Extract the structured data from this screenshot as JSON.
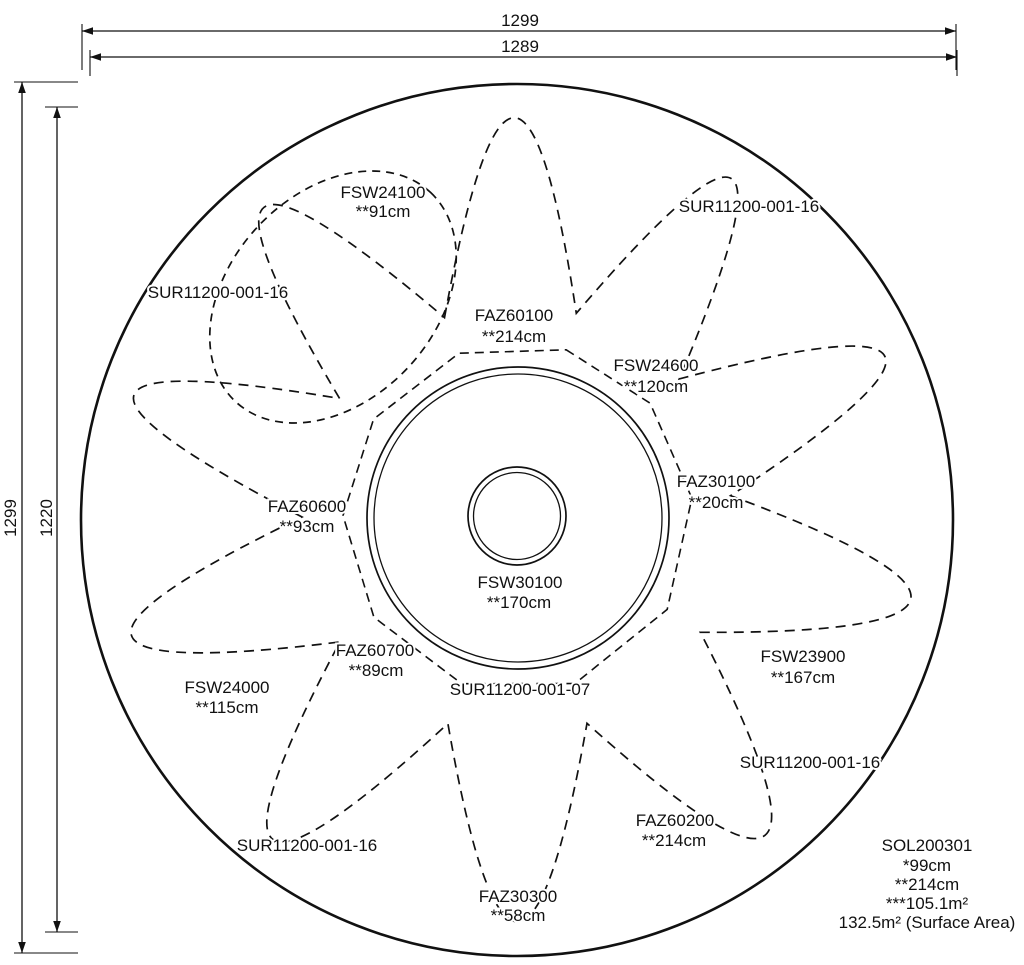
{
  "dimensions": {
    "top_outer": "1299",
    "top_inner": "1289",
    "left_outer": "1299",
    "left_inner": "1220"
  },
  "equipment": [
    {
      "code": "FSW24100",
      "height": "**91cm"
    },
    {
      "code": "FAZ60100",
      "height": "**214cm"
    },
    {
      "code": "FSW24600",
      "height": "**120cm"
    },
    {
      "code": "FAZ30100",
      "height": "**20cm"
    },
    {
      "code": "FAZ60600",
      "height": "**93cm"
    },
    {
      "code": "FSW30100",
      "height": "**170cm"
    },
    {
      "code": "FSW23900",
      "height": "**167cm"
    },
    {
      "code": "FSW24000",
      "height": "**115cm"
    },
    {
      "code": "FAZ60700",
      "height": "**89cm"
    },
    {
      "code": "FAZ60200",
      "height": "**214cm"
    },
    {
      "code": "FAZ30300",
      "height": "**58cm"
    }
  ],
  "surfacing": [
    {
      "code": "SUR11200-001-16"
    },
    {
      "code": "SUR11200-001-16"
    },
    {
      "code": "SUR11200-001-16"
    },
    {
      "code": "SUR11200-001-16"
    },
    {
      "code": "SUR11200-001-07"
    }
  ],
  "summary": {
    "code": "SOL200301",
    "line1": "*99cm",
    "line2": "**214cm",
    "line3": "***105.1m²",
    "line4": "132.5m² (Surface Area)"
  }
}
